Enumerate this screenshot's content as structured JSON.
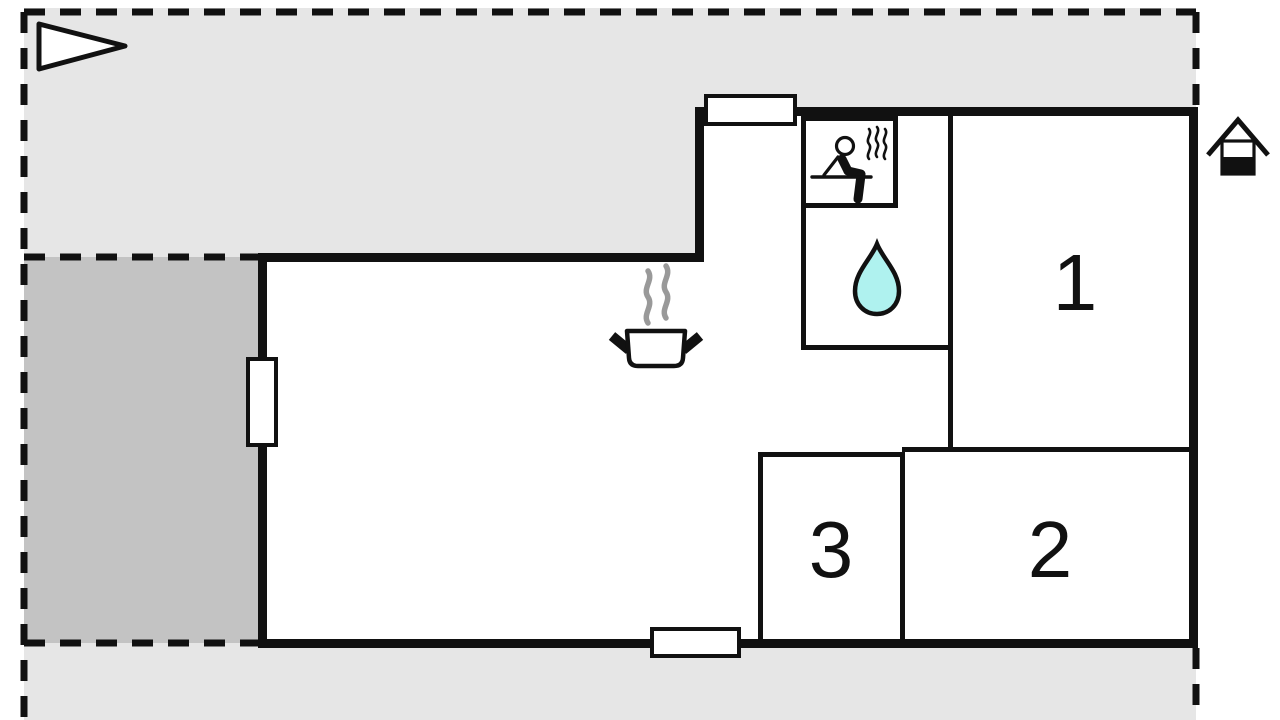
{
  "title": "Holiday home floor plan",
  "rooms": [
    {
      "label": "1"
    },
    {
      "label": "2"
    },
    {
      "label": "3"
    }
  ],
  "icons": [
    "direction-arrow-icon",
    "house-entrance-icon",
    "sauna-icon",
    "water-drop-icon",
    "cooking-pot-icon"
  ],
  "features": {
    "windows": 3,
    "terraces": 2,
    "sauna": true,
    "bathroom": true,
    "kitchen": true
  },
  "colors": {
    "plot": "#e6e6e6",
    "terrace": "#c3c3c3",
    "wall": "#111111",
    "water": "#aff2ef",
    "steam": "#999999",
    "room_fill": "#ffffff"
  }
}
